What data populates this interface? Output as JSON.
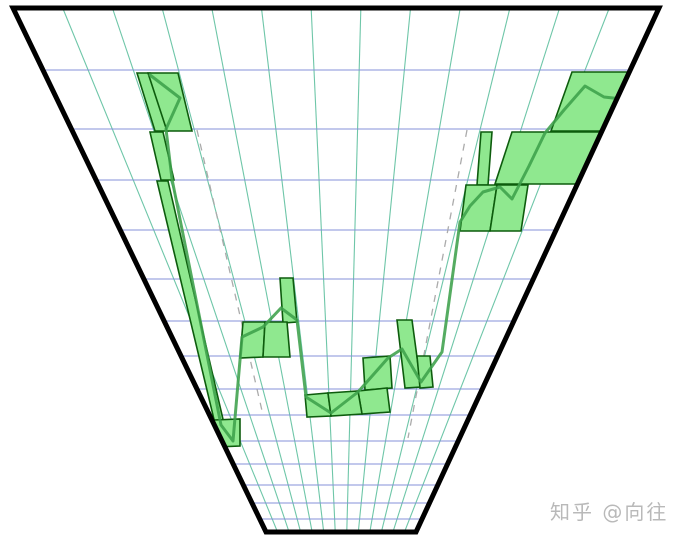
{
  "page": {
    "background": "#ffffff"
  },
  "watermark": {
    "text": "知乎 @向往",
    "color": "#b9b9b9"
  },
  "chart": {
    "width": 675,
    "height": 543,
    "trapezoid": {
      "top_left": [
        13,
        8
      ],
      "top_right": [
        659,
        8
      ],
      "bottom_right": [
        416,
        532
      ],
      "bottom_left": [
        266,
        532
      ]
    },
    "border_color": "#000000",
    "border_width": 5,
    "column_count": 13,
    "column_line_color": "#6ec6a8",
    "row_line_color": "#8490d8",
    "grid_line_width": 1.1,
    "rows_y": [
      8,
      70,
      129,
      180,
      230,
      279,
      321,
      356,
      389,
      415,
      441,
      464,
      485,
      503,
      519,
      532
    ],
    "dashed_color": "#ababab",
    "dashed_pattern": "7 7",
    "dashed_lines_px": [
      [
        [
          197,
          130
        ],
        [
          263,
          415
        ]
      ],
      [
        [
          467,
          130
        ],
        [
          408,
          438
        ]
      ]
    ],
    "bar_fill": "#8fe88f",
    "bar_stroke": "#0d5c0d",
    "bar_stroke_width": 1.6,
    "bars_px": [
      [
        [
          137,
          73
        ],
        [
          150,
          73
        ],
        [
          168,
          131
        ],
        [
          155,
          131
        ]
      ],
      [
        [
          148,
          73
        ],
        [
          178,
          73
        ],
        [
          192,
          131
        ],
        [
          167,
          131
        ]
      ],
      [
        [
          150,
          132
        ],
        [
          163,
          132
        ],
        [
          174,
          180
        ],
        [
          161,
          180
        ]
      ],
      [
        [
          157,
          181
        ],
        [
          168,
          181
        ],
        [
          225,
          428
        ],
        [
          217,
          432
        ]
      ],
      [
        [
          214,
          420
        ],
        [
          240,
          419
        ],
        [
          240,
          446
        ],
        [
          215,
          447
        ]
      ],
      [
        [
          280,
          278
        ],
        [
          293,
          278
        ],
        [
          297,
          322
        ],
        [
          283,
          323
        ]
      ],
      [
        [
          243,
          322
        ],
        [
          265,
          322
        ],
        [
          263,
          357
        ],
        [
          240,
          358
        ]
      ],
      [
        [
          265,
          322
        ],
        [
          287,
          322
        ],
        [
          290,
          357
        ],
        [
          263,
          357
        ]
      ],
      [
        [
          397,
          320
        ],
        [
          412,
          320
        ],
        [
          421,
          387
        ],
        [
          405,
          388
        ]
      ],
      [
        [
          363,
          358
        ],
        [
          390,
          356
        ],
        [
          392,
          388
        ],
        [
          365,
          390
        ]
      ],
      [
        [
          417,
          356
        ],
        [
          430,
          356
        ],
        [
          433,
          387
        ],
        [
          420,
          388
        ]
      ],
      [
        [
          358,
          391
        ],
        [
          387,
          388
        ],
        [
          390,
          412
        ],
        [
          362,
          414
        ]
      ],
      [
        [
          305,
          395
        ],
        [
          328,
          393
        ],
        [
          331,
          416
        ],
        [
          307,
          417
        ]
      ],
      [
        [
          328,
          393
        ],
        [
          358,
          391
        ],
        [
          362,
          414
        ],
        [
          331,
          416
        ]
      ],
      [
        [
          572,
          72
        ],
        [
          648,
          72
        ],
        [
          630,
          131
        ],
        [
          551,
          131
        ]
      ],
      [
        [
          512,
          132
        ],
        [
          610,
          132
        ],
        [
          592,
          184
        ],
        [
          495,
          184
        ]
      ],
      [
        [
          481,
          132
        ],
        [
          492,
          132
        ],
        [
          488,
          185
        ],
        [
          477,
          185
        ]
      ],
      [
        [
          466,
          185
        ],
        [
          497,
          185
        ],
        [
          490,
          231
        ],
        [
          460,
          231
        ]
      ],
      [
        [
          497,
          185
        ],
        [
          528,
          185
        ],
        [
          521,
          231
        ],
        [
          490,
          231
        ]
      ]
    ],
    "line_color": "#3da04b",
    "line_width": 3,
    "line_opacity": 0.88,
    "line_px": [
      [
        150,
        75
      ],
      [
        180,
        98
      ],
      [
        166,
        129
      ],
      [
        172,
        179
      ],
      [
        221,
        425
      ],
      [
        233,
        441
      ],
      [
        242,
        337
      ],
      [
        263,
        327
      ],
      [
        281,
        308
      ],
      [
        297,
        320
      ],
      [
        306,
        397
      ],
      [
        331,
        413
      ],
      [
        358,
        392
      ],
      [
        388,
        358
      ],
      [
        402,
        349
      ],
      [
        421,
        382
      ],
      [
        442,
        352
      ],
      [
        460,
        222
      ],
      [
        470,
        206
      ],
      [
        483,
        192
      ],
      [
        500,
        187
      ],
      [
        512,
        199
      ],
      [
        529,
        166
      ],
      [
        545,
        133
      ],
      [
        564,
        110
      ],
      [
        585,
        86
      ],
      [
        604,
        97
      ],
      [
        640,
        101
      ]
    ]
  },
  "chart_data": {
    "type": "bar",
    "projection": "perspective-funnel (chart plane receding toward a vanishing point below the image)",
    "title": "",
    "xlabel": "",
    "ylabel": "",
    "grid": {
      "columns": 13,
      "rows": 15,
      "column_lines": "teal, converging downward",
      "row_lines": "blue, horizontally compressed toward bottom"
    },
    "bars_grid": [
      {
        "col": [
          2.05,
          2.35
        ],
        "row": [
          1,
          2
        ]
      },
      {
        "col": [
          2.35,
          2.95
        ],
        "row": [
          1,
          2
        ]
      },
      {
        "col": [
          1.85,
          2.15
        ],
        "row": [
          2,
          3
        ]
      },
      {
        "col": [
          0.25,
          1.55
        ],
        "row": [
          9.2,
          10.2
        ]
      },
      {
        "col": [
          3.95,
          4.35
        ],
        "row": [
          5.1,
          6.1
        ]
      },
      {
        "col": [
          2.6,
          3.3
        ],
        "row": [
          6.2,
          7.2
        ]
      },
      {
        "col": [
          3.3,
          4.0
        ],
        "row": [
          6.2,
          7.2
        ]
      },
      {
        "col": [
          7.75,
          8.25
        ],
        "row": [
          6.1,
          8.0
        ]
      },
      {
        "col": [
          6.6,
          7.6
        ],
        "row": [
          7.2,
          8.1
        ]
      },
      {
        "col": [
          8.7,
          9.2
        ],
        "row": [
          7.2,
          8.05
        ]
      },
      {
        "col": [
          6.6,
          7.7
        ],
        "row": [
          8.1,
          9.0
        ]
      },
      {
        "col": [
          4.6,
          5.5
        ],
        "row": [
          8.2,
          9.1
        ]
      },
      {
        "col": [
          5.5,
          6.6
        ],
        "row": [
          8.15,
          9.05
        ]
      },
      {
        "col": [
          11.75,
          13.0
        ],
        "row": [
          1,
          2
        ]
      },
      {
        "col": [
          10.85,
          13.0
        ],
        "row": [
          2,
          3
        ]
      },
      {
        "col": [
          10.1,
          10.4
        ],
        "row": [
          2,
          3.1
        ]
      },
      {
        "col": [
          10.0,
          10.8
        ],
        "row": [
          3.1,
          4.05
        ]
      },
      {
        "col": [
          10.8,
          11.6
        ],
        "row": [
          3.1,
          4.05
        ]
      }
    ],
    "connector_strip_grid": {
      "from": [
        1.75,
        3
      ],
      "to": [
        0.3,
        9.7
      ],
      "note": "thin elongated green strip linking upper-left bars to lower-left bar"
    },
    "trend_line_grid": [
      [
        2.35,
        1.1
      ],
      [
        2.9,
        1.5
      ],
      [
        2.3,
        2.0
      ],
      [
        2.05,
        3.0
      ],
      [
        0.5,
        9.4
      ],
      [
        0.65,
        10.0
      ],
      [
        2.4,
        6.55
      ],
      [
        3.2,
        6.25
      ],
      [
        4.0,
        5.85
      ],
      [
        4.3,
        6.0
      ],
      [
        4.3,
        8.3
      ],
      [
        6.05,
        8.9
      ],
      [
        6.4,
        8.1
      ],
      [
        7.55,
        7.25
      ],
      [
        8.05,
        6.8
      ],
      [
        8.9,
        7.8
      ],
      [
        9.4,
        6.9
      ],
      [
        10.15,
        3.85
      ],
      [
        10.3,
        3.5
      ],
      [
        10.5,
        3.2
      ],
      [
        11.0,
        3.1
      ],
      [
        11.3,
        3.4
      ],
      [
        11.6,
        2.7
      ],
      [
        11.65,
        2.05
      ],
      [
        11.9,
        1.7
      ],
      [
        12.2,
        1.25
      ],
      [
        12.6,
        1.45
      ],
      [
        13.2,
        1.5
      ]
    ],
    "dashed_guides_grid": [
      {
        "from": [
          2.6,
          2
        ],
        "to": [
          2.6,
          9.0
        ],
        "side": "left"
      },
      {
        "from": [
          10.2,
          2
        ],
        "to": [
          9.0,
          10.0
        ],
        "side": "right"
      }
    ],
    "legend": "none",
    "axis_labels": "none (pure graphic)"
  }
}
